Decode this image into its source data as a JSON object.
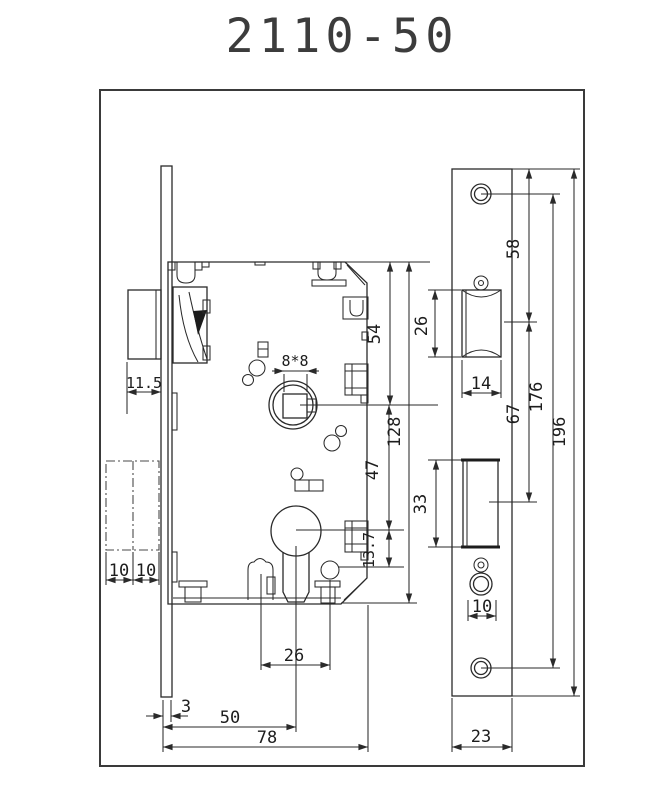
{
  "title": "2110-50",
  "dims": {
    "lock": {
      "latch_protrusion": "11.5",
      "spindle_square": "8*8",
      "top_to_spindle": "54",
      "case_height": "128",
      "spindle_to_cylinder": "47",
      "cylinder_to_pin": "13.7",
      "door_thickness_left": "10",
      "door_thickness_right": "10",
      "post_spacing": "26",
      "faceplate_thickness": "3",
      "backset": "50",
      "case_depth": "78"
    },
    "strike": {
      "latch_cutout_height": "26",
      "top_to_latch_center": "58",
      "latch_cutout_width": "14",
      "latch_to_bolt_center": "67",
      "screw_center_distance": "176",
      "plate_height": "196",
      "bolt_cutout_height": "33",
      "bolt_hole_width": "10",
      "plate_width": "23"
    }
  }
}
